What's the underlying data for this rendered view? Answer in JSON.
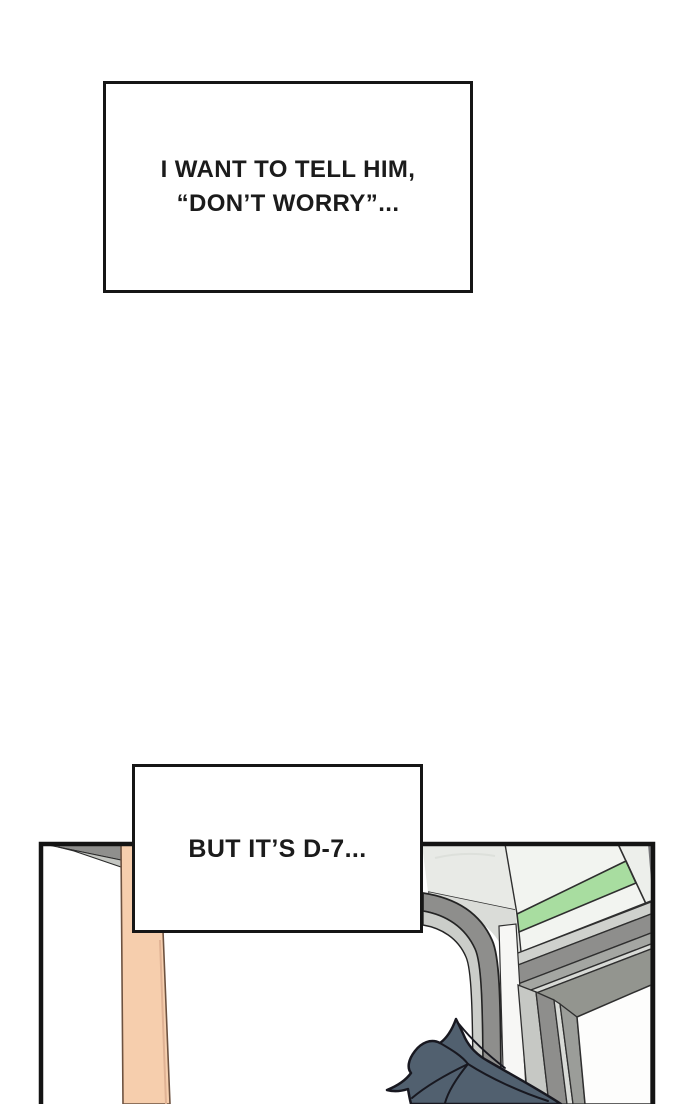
{
  "page": {
    "kind": "webtoon-comic-page",
    "background": "#ffffff"
  },
  "captions": [
    {
      "id": "narration-1",
      "lines": [
        "I WANT TO TELL HIM,",
        "“DON’T WORRY”..."
      ]
    },
    {
      "id": "narration-2",
      "lines": [
        "BUT IT’S D-7..."
      ]
    }
  ],
  "panel_scene": {
    "description": "train interior: door corner with green stripe wall band, door window, peach pillar, top of character's dark hair"
  },
  "colors": {
    "ink": "#161616",
    "peach": "#f6cead",
    "peach-outline": "#6d5240",
    "hair": "#51606f",
    "hair-ink": "#181820",
    "green": "#a8dda0",
    "wall": "#f2f4f0",
    "wall-left": "#e8eae6",
    "gray-dark": "#8e8e8c",
    "gray-mid": "#a4a6a2",
    "gray-light": "#cbcdc9",
    "window": "#fdfdfc"
  }
}
